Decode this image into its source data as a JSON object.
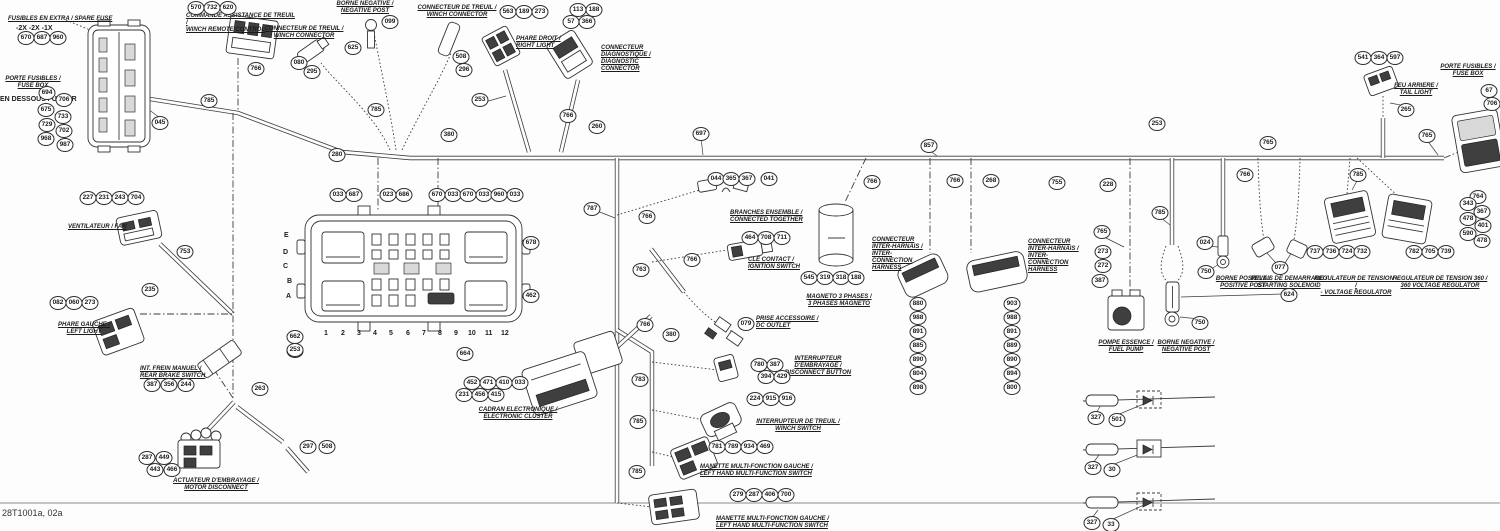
{
  "meta": {
    "sheet_id": "28T1001a, 02a"
  },
  "colors": {
    "ink": "#2e2e2e",
    "background": "#fdfdfd"
  },
  "relay_box": {
    "row_letters": [
      "E",
      "D",
      "C",
      "B",
      "A"
    ],
    "column_numbers": [
      "1",
      "2",
      "3",
      "4",
      "5",
      "6",
      "7",
      "8",
      "9",
      "10",
      "11",
      "12"
    ]
  },
  "labels": [
    {
      "fr": "FUSIBLES EN EXTRA / SPARE FUSE",
      "en": "",
      "x": 8,
      "y": 16,
      "w": 130,
      "align": "left"
    },
    {
      "fr": "COMMANDE ASSISTANCE DE TREUIL /",
      "en": "WINCH REMOTE CONTROL",
      "x": 186,
      "y": 13,
      "w": 112,
      "align": "left"
    },
    {
      "fr": "PORTE FUSIBLES /",
      "en": "FUSE BOX",
      "x": 0,
      "y": 76,
      "w": 66,
      "align": "center"
    },
    {
      "fr": "CONNECTEUR DE TREUIL /",
      "en": "WINCH CONNECTOR",
      "x": 262,
      "y": 26,
      "w": 84,
      "align": "center"
    },
    {
      "fr": "BORNE NEGATIVE /",
      "en": "NEGATIVE POST",
      "x": 328,
      "y": 1,
      "w": 74,
      "align": "center"
    },
    {
      "fr": "CONNECTEUR DE TREUIL /",
      "en": "WINCH CONNECTOR",
      "x": 412,
      "y": 5,
      "w": 90,
      "align": "center"
    },
    {
      "fr": "PHARE DROIT /",
      "en": "RIGHT LIGHT",
      "x": 516,
      "y": 36,
      "w": 56,
      "align": "left"
    },
    {
      "fr": "CONNECTEUR DIAGNOSTIQUE /",
      "en": "DIAGNOSTIC CONNECTOR",
      "x": 601,
      "y": 45,
      "w": 64,
      "align": "left"
    },
    {
      "fr": "VENTILATEUR / FAN",
      "en": "",
      "x": 68,
      "y": 224,
      "w": 90,
      "align": "left"
    },
    {
      "fr": "PHARE GAUCHE /",
      "en": "LEFT LIGHT",
      "x": 58,
      "y": 322,
      "w": 52,
      "align": "center"
    },
    {
      "fr": "INT. FREIN MANUEL /",
      "en": "REAR BRAKE SWITCH",
      "x": 140,
      "y": 366,
      "w": 78,
      "align": "left"
    },
    {
      "fr": "ACTUATEUR D'EMBRAYAGE /",
      "en": "MOTOR DISCONNECT",
      "x": 172,
      "y": 478,
      "w": 88,
      "align": "center"
    },
    {
      "fr": "CADRAN ELECTRONIQUE /",
      "en": "ELECTRONIC CLUSTER",
      "x": 468,
      "y": 407,
      "w": 100,
      "align": "center"
    },
    {
      "fr": "BRANCHES ENSEMBLE /",
      "en": "CONNECTED TOGETHER",
      "x": 730,
      "y": 210,
      "w": 85,
      "align": "left"
    },
    {
      "fr": "CLE CONTACT /",
      "en": "IGNITION SWITCH",
      "x": 748,
      "y": 257,
      "w": 72,
      "align": "left"
    },
    {
      "fr": "PRISE ACCESSOIRE /",
      "en": "DC OUTLET",
      "x": 756,
      "y": 316,
      "w": 82,
      "align": "left"
    },
    {
      "fr": "INTERRUPTEUR D'EMBRAYAGE /",
      "en": "DISCONNECT BUTTON",
      "x": 782,
      "y": 356,
      "w": 72,
      "align": "center"
    },
    {
      "fr": "INTERRUPTEUR DE TREUIL /",
      "en": "WINCH SWITCH",
      "x": 748,
      "y": 419,
      "w": 100,
      "align": "center"
    },
    {
      "fr": "MANETTE MULTI-FONCTION GAUCHE /",
      "en": "LEFT HAND MULTI-FUNCTION SWITCH",
      "x": 700,
      "y": 464,
      "w": 130,
      "align": "left"
    },
    {
      "fr": "MANETTE MULTI-FONCTION GAUCHE /",
      "en": "LEFT HAND MULTI-FUNCTION SWITCH",
      "x": 716,
      "y": 516,
      "w": 130,
      "align": "left"
    },
    {
      "fr": "MAGNETO 3 PHASES /",
      "en": "3 PHASES MAGNETO",
      "x": 794,
      "y": 294,
      "w": 90,
      "align": "center"
    },
    {
      "fr": "CONNECTEUR INTER-HARNAIS /",
      "en": "INTER- CONNECTION HARNESS",
      "x": 872,
      "y": 237,
      "w": 58,
      "align": "left"
    },
    {
      "fr": "CONNECTEUR INTER-HARNAIS /",
      "en": "INTER- CONNECTION HARNESS",
      "x": 1028,
      "y": 239,
      "w": 58,
      "align": "left"
    },
    {
      "fr": "POMPE ESSENCE /",
      "en": "FUEL PUMP",
      "x": 1090,
      "y": 340,
      "w": 72,
      "align": "center"
    },
    {
      "fr": "BORNE NEGATIVE /",
      "en": "NEGATIVE POST",
      "x": 1150,
      "y": 340,
      "w": 72,
      "align": "center"
    },
    {
      "fr": "BORNE POSITIVE /",
      "en": "POSITIVE POST",
      "x": 1210,
      "y": 276,
      "w": 66,
      "align": "center"
    },
    {
      "fr": "RELAIS DE DEMARRAGE /",
      "en": "STARTING SOLENOID",
      "x": 1248,
      "y": 276,
      "w": 82,
      "align": "center"
    },
    {
      "fr": "REGULATEUR DE TENSION - /",
      "en": "- VOLTAGE REGULATOR",
      "x": 1314,
      "y": 276,
      "w": 84,
      "align": "center"
    },
    {
      "fr": "REGULATEUR DE TENSION 360 /",
      "en": "360 VOLTAGE REGULATOR",
      "x": 1392,
      "y": 276,
      "w": 96,
      "align": "center"
    },
    {
      "fr": "FEU ARRIERE /",
      "en": "TAIL LIGHT",
      "x": 1392,
      "y": 83,
      "w": 48,
      "align": "center"
    },
    {
      "fr": "PORTE FUSIBLES /",
      "en": "FUSE BOX",
      "x": 1438,
      "y": 64,
      "w": 60,
      "align": "center"
    }
  ],
  "texts": [
    {
      "t": "-2X  -2X  -1X",
      "x": 16,
      "y": 25
    },
    {
      "t": "EN DESSOUS / UNDER",
      "x": 0,
      "y": 96
    },
    {
      "t": "E",
      "x": 284,
      "y": 232
    },
    {
      "t": "D",
      "x": 283,
      "y": 249
    },
    {
      "t": "C",
      "x": 283,
      "y": 263
    },
    {
      "t": "B",
      "x": 287,
      "y": 278
    },
    {
      "t": "A",
      "x": 286,
      "y": 293
    },
    {
      "t": "1",
      "x": 324,
      "y": 330
    },
    {
      "t": "2",
      "x": 341,
      "y": 330
    },
    {
      "t": "3",
      "x": 357,
      "y": 330
    },
    {
      "t": "4",
      "x": 373,
      "y": 330
    },
    {
      "t": "5",
      "x": 389,
      "y": 330
    },
    {
      "t": "6",
      "x": 406,
      "y": 330
    },
    {
      "t": "7",
      "x": 422,
      "y": 330
    },
    {
      "t": "8",
      "x": 438,
      "y": 330
    },
    {
      "t": "9",
      "x": 454,
      "y": 330
    },
    {
      "t": "10",
      "x": 468,
      "y": 330
    },
    {
      "t": "11",
      "x": 485,
      "y": 330
    },
    {
      "t": "12",
      "x": 501,
      "y": 330
    }
  ],
  "refs": [
    {
      "v": "670",
      "x": 26,
      "y": 38
    },
    {
      "v": "687",
      "x": 42,
      "y": 38
    },
    {
      "v": "960",
      "x": 58,
      "y": 38
    },
    {
      "v": "570",
      "x": 196,
      "y": 8
    },
    {
      "v": "732",
      "x": 212,
      "y": 8
    },
    {
      "v": "620",
      "x": 228,
      "y": 8
    },
    {
      "v": "694",
      "x": 47,
      "y": 93
    },
    {
      "v": "706",
      "x": 64,
      "y": 100
    },
    {
      "v": "675",
      "x": 46,
      "y": 110
    },
    {
      "v": "733",
      "x": 63,
      "y": 117
    },
    {
      "v": "729",
      "x": 47,
      "y": 125
    },
    {
      "v": "702",
      "x": 64,
      "y": 131
    },
    {
      "v": "968",
      "x": 46,
      "y": 139
    },
    {
      "v": "987",
      "x": 65,
      "y": 145
    },
    {
      "v": "045",
      "x": 160,
      "y": 123
    },
    {
      "v": "785",
      "x": 209,
      "y": 101
    },
    {
      "v": "766",
      "x": 256,
      "y": 69
    },
    {
      "v": "080",
      "x": 299,
      "y": 63
    },
    {
      "v": "295",
      "x": 312,
      "y": 72
    },
    {
      "v": "625",
      "x": 353,
      "y": 48
    },
    {
      "v": "099",
      "x": 390,
      "y": 22
    },
    {
      "v": "508",
      "x": 461,
      "y": 57
    },
    {
      "v": "296",
      "x": 464,
      "y": 70
    },
    {
      "v": "563",
      "x": 508,
      "y": 12
    },
    {
      "v": "189",
      "x": 524,
      "y": 12
    },
    {
      "v": "273",
      "x": 540,
      "y": 12
    },
    {
      "v": "113",
      "x": 578,
      "y": 10
    },
    {
      "v": "188",
      "x": 594,
      "y": 10
    },
    {
      "v": "57",
      "x": 571,
      "y": 22
    },
    {
      "v": "366",
      "x": 587,
      "y": 22
    },
    {
      "v": "253",
      "x": 480,
      "y": 100
    },
    {
      "v": "766",
      "x": 568,
      "y": 116
    },
    {
      "v": "785",
      "x": 376,
      "y": 110
    },
    {
      "v": "280",
      "x": 337,
      "y": 155
    },
    {
      "v": "380",
      "x": 449,
      "y": 135
    },
    {
      "v": "260",
      "x": 597,
      "y": 127
    },
    {
      "v": "697",
      "x": 701,
      "y": 134
    },
    {
      "v": "033",
      "x": 338,
      "y": 195
    },
    {
      "v": "687",
      "x": 354,
      "y": 195
    },
    {
      "v": "023",
      "x": 388,
      "y": 195
    },
    {
      "v": "686",
      "x": 404,
      "y": 195
    },
    {
      "v": "670",
      "x": 437,
      "y": 195
    },
    {
      "v": "033",
      "x": 453,
      "y": 195
    },
    {
      "v": "670",
      "x": 468,
      "y": 195
    },
    {
      "v": "033",
      "x": 484,
      "y": 195
    },
    {
      "v": "960",
      "x": 499,
      "y": 195
    },
    {
      "v": "033",
      "x": 515,
      "y": 195
    },
    {
      "v": "662",
      "x": 295,
      "y": 337
    },
    {
      "v": "033",
      "x": 295,
      "y": 351
    },
    {
      "v": "678",
      "x": 531,
      "y": 243
    },
    {
      "v": "462",
      "x": 531,
      "y": 296
    },
    {
      "v": "664",
      "x": 465,
      "y": 354
    },
    {
      "v": "452",
      "x": 472,
      "y": 383
    },
    {
      "v": "471",
      "x": 488,
      "y": 383
    },
    {
      "v": "410",
      "x": 504,
      "y": 383
    },
    {
      "v": "033",
      "x": 520,
      "y": 383
    },
    {
      "v": "231",
      "x": 464,
      "y": 395
    },
    {
      "v": "456",
      "x": 480,
      "y": 395
    },
    {
      "v": "415",
      "x": 496,
      "y": 395
    },
    {
      "v": "787",
      "x": 592,
      "y": 209
    },
    {
      "v": "766",
      "x": 647,
      "y": 217
    },
    {
      "v": "763",
      "x": 641,
      "y": 270
    },
    {
      "v": "766",
      "x": 692,
      "y": 260
    },
    {
      "v": "766",
      "x": 645,
      "y": 325
    },
    {
      "v": "380",
      "x": 671,
      "y": 335
    },
    {
      "v": "783",
      "x": 640,
      "y": 380
    },
    {
      "v": "785",
      "x": 638,
      "y": 422
    },
    {
      "v": "785",
      "x": 637,
      "y": 472
    },
    {
      "v": "044",
      "x": 716,
      "y": 179
    },
    {
      "v": "365",
      "x": 731,
      "y": 179
    },
    {
      "v": "367",
      "x": 747,
      "y": 179
    },
    {
      "v": "041",
      "x": 769,
      "y": 179
    },
    {
      "v": "464",
      "x": 750,
      "y": 238
    },
    {
      "v": "708",
      "x": 766,
      "y": 238
    },
    {
      "v": "711",
      "x": 782,
      "y": 238
    },
    {
      "v": "079",
      "x": 746,
      "y": 324
    },
    {
      "v": "780",
      "x": 759,
      "y": 365
    },
    {
      "v": "387",
      "x": 775,
      "y": 365
    },
    {
      "v": "394",
      "x": 766,
      "y": 377
    },
    {
      "v": "429",
      "x": 782,
      "y": 377
    },
    {
      "v": "224",
      "x": 755,
      "y": 399
    },
    {
      "v": "915",
      "x": 771,
      "y": 399
    },
    {
      "v": "916",
      "x": 787,
      "y": 399
    },
    {
      "v": "781",
      "x": 717,
      "y": 447
    },
    {
      "v": "789",
      "x": 733,
      "y": 447
    },
    {
      "v": "934",
      "x": 749,
      "y": 447
    },
    {
      "v": "469",
      "x": 765,
      "y": 447
    },
    {
      "v": "279",
      "x": 738,
      "y": 495
    },
    {
      "v": "287",
      "x": 754,
      "y": 495
    },
    {
      "v": "406",
      "x": 770,
      "y": 495
    },
    {
      "v": "700",
      "x": 786,
      "y": 495
    },
    {
      "v": "545",
      "x": 809,
      "y": 278
    },
    {
      "v": "319",
      "x": 825,
      "y": 278
    },
    {
      "v": "318",
      "x": 841,
      "y": 278
    },
    {
      "v": "188",
      "x": 856,
      "y": 278
    },
    {
      "v": "766",
      "x": 872,
      "y": 182
    },
    {
      "v": "880",
      "x": 918,
      "y": 304
    },
    {
      "v": "988",
      "x": 918,
      "y": 318
    },
    {
      "v": "891",
      "x": 918,
      "y": 332
    },
    {
      "v": "885",
      "x": 918,
      "y": 346
    },
    {
      "v": "890",
      "x": 918,
      "y": 360
    },
    {
      "v": "804",
      "x": 918,
      "y": 374
    },
    {
      "v": "898",
      "x": 918,
      "y": 388
    },
    {
      "v": "903",
      "x": 1012,
      "y": 304
    },
    {
      "v": "988",
      "x": 1012,
      "y": 318
    },
    {
      "v": "891",
      "x": 1012,
      "y": 332
    },
    {
      "v": "889",
      "x": 1012,
      "y": 346
    },
    {
      "v": "890",
      "x": 1012,
      "y": 360
    },
    {
      "v": "894",
      "x": 1012,
      "y": 374
    },
    {
      "v": "800",
      "x": 1012,
      "y": 388
    },
    {
      "v": "857",
      "x": 929,
      "y": 146
    },
    {
      "v": "766",
      "x": 955,
      "y": 181
    },
    {
      "v": "268",
      "x": 991,
      "y": 181
    },
    {
      "v": "755",
      "x": 1057,
      "y": 183
    },
    {
      "v": "228",
      "x": 1108,
      "y": 185
    },
    {
      "v": "253",
      "x": 1157,
      "y": 124
    },
    {
      "v": "766",
      "x": 1245,
      "y": 175
    },
    {
      "v": "765",
      "x": 1268,
      "y": 143
    },
    {
      "v": "765",
      "x": 1102,
      "y": 232
    },
    {
      "v": "273",
      "x": 1103,
      "y": 252
    },
    {
      "v": "272",
      "x": 1103,
      "y": 266
    },
    {
      "v": "387",
      "x": 1100,
      "y": 281
    },
    {
      "v": "785",
      "x": 1160,
      "y": 213
    },
    {
      "v": "624",
      "x": 1289,
      "y": 295
    },
    {
      "v": "750",
      "x": 1200,
      "y": 323
    },
    {
      "v": "024",
      "x": 1205,
      "y": 243
    },
    {
      "v": "750",
      "x": 1206,
      "y": 272
    },
    {
      "v": "077",
      "x": 1280,
      "y": 268
    },
    {
      "v": "785",
      "x": 1358,
      "y": 175
    },
    {
      "v": "737",
      "x": 1315,
      "y": 252
    },
    {
      "v": "736",
      "x": 1331,
      "y": 252
    },
    {
      "v": "724",
      "x": 1347,
      "y": 252
    },
    {
      "v": "732",
      "x": 1362,
      "y": 252
    },
    {
      "v": "782",
      "x": 1414,
      "y": 252
    },
    {
      "v": "705",
      "x": 1430,
      "y": 252
    },
    {
      "v": "739",
      "x": 1446,
      "y": 252
    },
    {
      "v": "764",
      "x": 1478,
      "y": 197
    },
    {
      "v": "343",
      "x": 1468,
      "y": 204
    },
    {
      "v": "367",
      "x": 1482,
      "y": 212
    },
    {
      "v": "478",
      "x": 1468,
      "y": 219
    },
    {
      "v": "401",
      "x": 1483,
      "y": 226
    },
    {
      "v": "590",
      "x": 1468,
      "y": 234
    },
    {
      "v": "478",
      "x": 1482,
      "y": 241
    },
    {
      "v": "541",
      "x": 1363,
      "y": 58
    },
    {
      "v": "364",
      "x": 1379,
      "y": 58
    },
    {
      "v": "597",
      "x": 1395,
      "y": 58
    },
    {
      "v": "265",
      "x": 1406,
      "y": 110
    },
    {
      "v": "67",
      "x": 1489,
      "y": 91
    },
    {
      "v": "706",
      "x": 1492,
      "y": 104
    },
    {
      "v": "765",
      "x": 1427,
      "y": 136
    },
    {
      "v": "253",
      "x": 295,
      "y": 350
    },
    {
      "v": "263",
      "x": 260,
      "y": 389
    },
    {
      "v": "297",
      "x": 308,
      "y": 447
    },
    {
      "v": "508",
      "x": 327,
      "y": 447
    },
    {
      "v": "235",
      "x": 150,
      "y": 290
    },
    {
      "v": "753",
      "x": 185,
      "y": 252
    },
    {
      "v": "227",
      "x": 88,
      "y": 198
    },
    {
      "v": "231",
      "x": 104,
      "y": 198
    },
    {
      "v": "243",
      "x": 120,
      "y": 198
    },
    {
      "v": "704",
      "x": 136,
      "y": 198
    },
    {
      "v": "082",
      "x": 58,
      "y": 303
    },
    {
      "v": "060",
      "x": 74,
      "y": 303
    },
    {
      "v": "273",
      "x": 90,
      "y": 303
    },
    {
      "v": "387",
      "x": 152,
      "y": 385
    },
    {
      "v": "356",
      "x": 169,
      "y": 385
    },
    {
      "v": "244",
      "x": 186,
      "y": 385
    },
    {
      "v": "287",
      "x": 147,
      "y": 458
    },
    {
      "v": "449",
      "x": 164,
      "y": 458
    },
    {
      "v": "443",
      "x": 155,
      "y": 470
    },
    {
      "v": "466",
      "x": 172,
      "y": 470
    },
    {
      "v": "327",
      "x": 1096,
      "y": 418
    },
    {
      "v": "501",
      "x": 1117,
      "y": 420
    },
    {
      "v": "327",
      "x": 1093,
      "y": 468
    },
    {
      "v": "30",
      "x": 1112,
      "y": 470
    },
    {
      "v": "327",
      "x": 1092,
      "y": 523
    },
    {
      "v": "33",
      "x": 1111,
      "y": 525
    }
  ]
}
